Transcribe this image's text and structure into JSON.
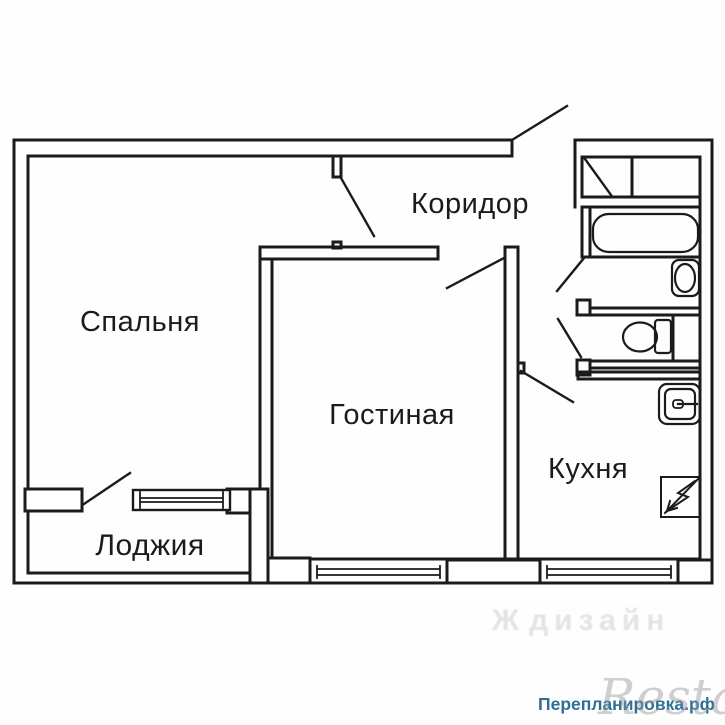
{
  "plan": {
    "line_color": "#1b1b1b",
    "rooms": [
      {
        "id": "bedroom",
        "label": "Спальня"
      },
      {
        "id": "corridor",
        "label": "Коридор"
      },
      {
        "id": "living_room",
        "label": "Гостиная"
      },
      {
        "id": "kitchen",
        "label": "Кухня"
      },
      {
        "id": "loggia",
        "label": "Лоджия"
      }
    ],
    "fixtures": [
      {
        "name": "bathtub-icon"
      },
      {
        "name": "washbasin-icon"
      },
      {
        "name": "toilet-icon"
      },
      {
        "name": "kitchen-sink-icon"
      },
      {
        "name": "electric-stove-icon"
      },
      {
        "name": "built-in-closet-icon"
      }
    ]
  },
  "watermarks": {
    "design_mark": "Ж",
    "design_text": "дизайн",
    "design_color": "#e4e4e4",
    "site_text": "Перепланировка.рф",
    "site_color": "#2d6f96",
    "brand_text": "Restate",
    "brand_color": "#bdbdbd"
  }
}
